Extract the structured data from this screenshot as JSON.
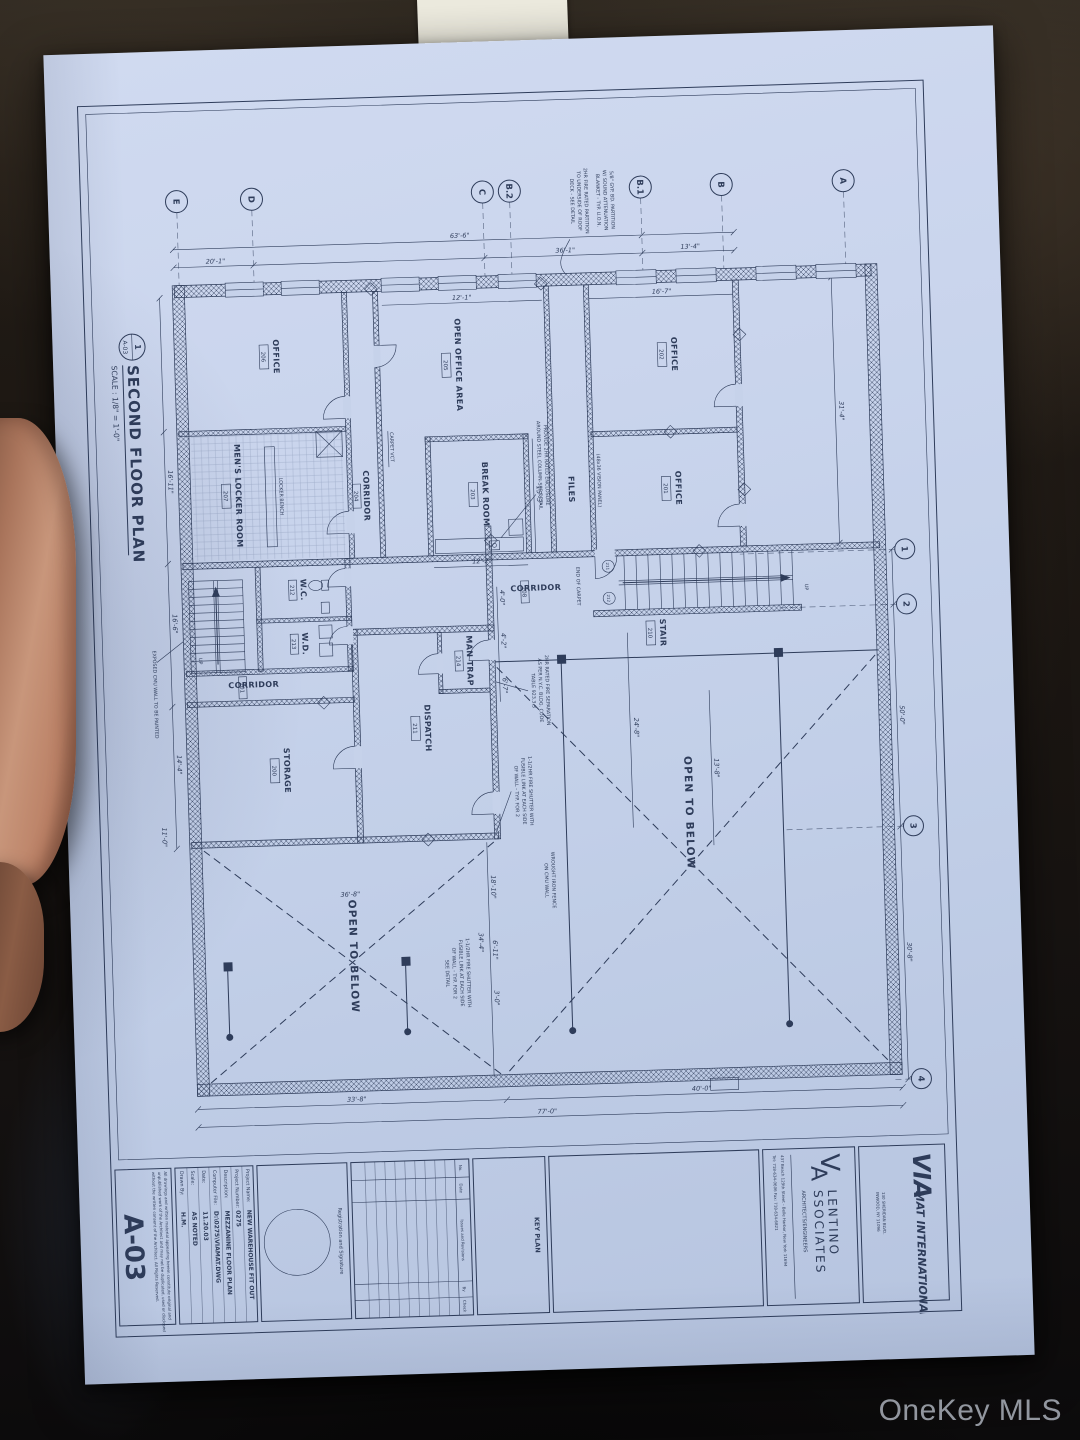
{
  "watermark": "OneKey MLS",
  "plan": {
    "title": "SECOND FLOOR PLAN",
    "scale": "SCALE : 1/8\" = 1'-0\"",
    "marker_top": "1",
    "marker_bottom": "A-03",
    "grid": {
      "letters": [
        "A",
        "B",
        "B.1",
        "B.2",
        "C",
        "D",
        "E"
      ],
      "numbers": [
        "1",
        "2",
        "3",
        "4"
      ]
    },
    "rooms": [
      {
        "name": "OFFICE",
        "tag": "206"
      },
      {
        "name": "OPEN OFFICE AREA",
        "tag": "205"
      },
      {
        "name": "OFFICE",
        "tag": "202"
      },
      {
        "name": "OFFICE",
        "tag": "201"
      },
      {
        "name": "FILES",
        "tag": ""
      },
      {
        "name": "MEN'S LOCKER ROOM",
        "tag": "207"
      },
      {
        "name": "CORRIDOR",
        "tag": "204"
      },
      {
        "name": "BREAK ROOM",
        "tag": "203"
      },
      {
        "name": "CORRIDOR",
        "tag": "208"
      },
      {
        "name": "STAIR",
        "tag": "210"
      },
      {
        "name": "W.C.",
        "tag": "212"
      },
      {
        "name": "W.D.",
        "tag": "213"
      },
      {
        "name": "MAN TRAP",
        "tag": "214"
      },
      {
        "name": "CORRIDOR",
        "tag": "201"
      },
      {
        "name": "STORAGE",
        "tag": "200"
      },
      {
        "name": "DISPATCH",
        "tag": "211"
      },
      {
        "name": "OPEN TO BELOW",
        "tag": ""
      },
      {
        "name": "OPEN TO BELOW",
        "tag": ""
      }
    ],
    "notes": {
      "col": [
        "PROVIDE 2HR RATED ENCLOSURE",
        "AROUND STEEL COLUMN-SEE DETAIL"
      ],
      "sep": [
        "2HR RATED FIRE SEPARATION",
        "AS PER N.Y.C. BLDG. CODE",
        "TABLE 923.3.3"
      ],
      "fs1": [
        "1-1/2HR FIRE SHUTTER WITH",
        "FUSIBLE LINK AT EACH SIDE",
        "OF WALL - TYP. FOR 2"
      ],
      "fence": [
        "WROUGHT IRON FENCE",
        "ON CMU WALL"
      ],
      "fs2": [
        "1-1/2HR FIRE SHUTTER WITH",
        "FUSIBLE LINK AT EACH SIDE",
        "OF WALL - TYP. FOR 2",
        "SEE DETAIL"
      ],
      "cmu": "EXPOSED CMU WALL TO BE PAINTED",
      "endcarpet": "END OF CARPET",
      "carpetvct": "CARPET   VCT",
      "vision": "(48x36 VISION PANEL)",
      "bench": "LOCKER BENCH",
      "na": [
        "5/8\" GYP. BD. PARTITION",
        "W/ SOUND ATTENUATION",
        "BLANKET - TYP. U.O.N."
      ],
      "nb": [
        "2HR FIRE RATED PARTITION",
        "TO UNDERSIDE OF ROOF",
        "DECK - SEE DETAIL"
      ],
      "up": "UP"
    },
    "dims": {
      "left": [
        "13'-4\"",
        "36'-1\"",
        "20'-1\"",
        "63'-6\""
      ],
      "top": [
        "31'-4\"",
        "50'-0\"",
        "30'-8\""
      ],
      "right": [
        "40'-0\"",
        "33'-8\"",
        "77'-0\""
      ],
      "bottom": [
        "16'-11\"",
        "16'-6\"",
        "14'-4\""
      ],
      "inner": [
        "15'-3\"",
        "12'-2\"",
        "16'-7\"",
        "12'-1\"",
        "24'-8\"",
        "13'-8\"",
        "4'-0\"",
        "4'-2\"",
        "6'-7\"",
        "3'-0\"",
        "18'-10\"",
        "6'-11\"",
        "34'-4\"",
        "36'-8\"",
        "11'-0\""
      ]
    },
    "door_tags": [
      "211",
      "212"
    ]
  },
  "title_block": {
    "firm1": {
      "logo": "VIA",
      "name": "MAT INTERNATIONAL",
      "addr1": "130 SHERIDAN BLVD.",
      "addr2": "INWOOD, NY 11096"
    },
    "firm2": {
      "logo_v": "V",
      "logo_a": "A",
      "name1": "LENTINO",
      "name2": "SSOCIATES",
      "subtitle": "ARCHITECTS/ENGINEERS",
      "addr": "437 Beach 129th Street - Belle Harbor, New York 11694",
      "phone": "Tel: 718-634-0606   Fax: 718-634-6821"
    },
    "key_plan": "KEY PLAN",
    "revisions": {
      "headers": [
        "No.",
        "Date",
        "Issues and Revisions",
        "By",
        "Check"
      ]
    },
    "registration": "Registration and Signature",
    "project": {
      "rows": [
        {
          "label": "Project Name:",
          "value": "NEW WAREHOUSE FIT OUT"
        },
        {
          "label": "Project Number:",
          "value": "0275"
        },
        {
          "label": "Description:",
          "value": "MEZZANINE FLOOR PLAN"
        },
        {
          "label": "Computer File:",
          "value": "D:\\0275\\VIAMAT.DWG"
        },
        {
          "label": "Date:",
          "value": "11.20.03"
        },
        {
          "label": "Scale:",
          "value": "AS NOTED"
        },
        {
          "label": "Drawn By:",
          "value": "H.M."
        }
      ]
    },
    "disclaimer1": "All drawings and written material appearing herein constitute original and",
    "disclaimer2": "unpublished work of the Architect and may not be duplicated, used or disclosed",
    "disclaimer3": "without the written consent of the Architect.  All Rights Reserved.",
    "sheet_number": "A-03"
  }
}
